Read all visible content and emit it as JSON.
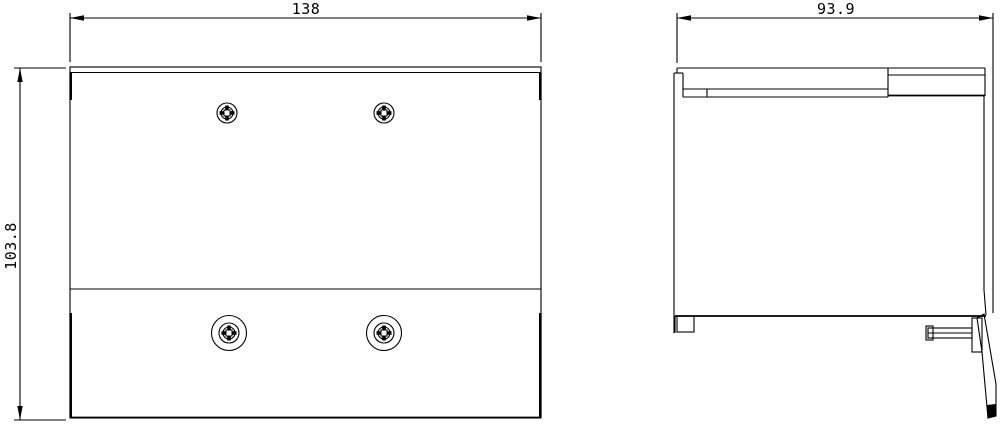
{
  "drawing": {
    "type": "technical-dimension-drawing",
    "background_color": "#ffffff",
    "line_color": "#000000",
    "views": {
      "front_view": {
        "label": "front view",
        "features": [
          "top-band",
          "separator-line",
          "two-small-screws-top",
          "two-large-screws-bottom"
        ]
      },
      "side_view": {
        "label": "side view",
        "features": [
          "front-face",
          "top-band",
          "din-rail-block",
          "bottom-foot",
          "slide-latch-with-screw"
        ]
      }
    },
    "dimensions": {
      "width": {
        "value": "138"
      },
      "height": {
        "value": "103.8"
      },
      "depth": {
        "value": "93.9"
      }
    }
  }
}
